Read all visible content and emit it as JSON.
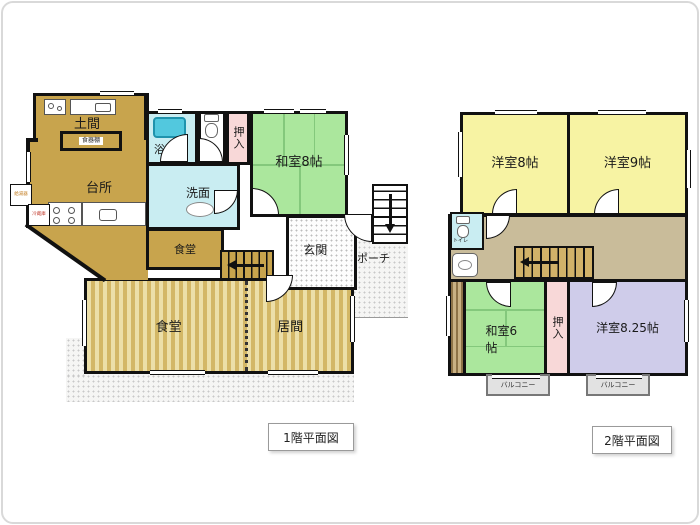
{
  "colors": {
    "wall": "#111111",
    "tan_floor_1f": "#c8a44d",
    "hall_floor_2f": "#c9bc9a",
    "tatami_green": "#abe79d",
    "western_yellow": "#f7f3a3",
    "western_lavender": "#cfccea",
    "closet_pink": "#f8d8d8",
    "wet_area_cyan": "#c9edf2",
    "stripe_light": "#ecdfa8",
    "stripe_dark": "#d3b766"
  },
  "f1": {
    "caption": "1階平面図",
    "rooms": {
      "doma": "土間",
      "kitchen": "台所",
      "bath": "浴室",
      "toilet": "トイレ",
      "closet": "押入",
      "washitsu8": "和室8帖",
      "washroom": "洗面",
      "dining_small": "食堂",
      "dining": "食堂",
      "living": "居間",
      "entrance": "玄関",
      "porch": "ポーチ"
    },
    "fixtures": {
      "cupboard": "食器棚",
      "water_heater": "給湯器",
      "fridge": "冷蔵庫"
    }
  },
  "f2": {
    "caption": "2階平面図",
    "rooms": {
      "western8": "洋室8帖",
      "western9": "洋室9帖",
      "washitsu6": "和室6帖",
      "closet": "押入",
      "western825": "洋室8.25帖",
      "toilet": "トイレ",
      "balcony_left": "バルコニー",
      "balcony_right": "バルコニー"
    }
  }
}
